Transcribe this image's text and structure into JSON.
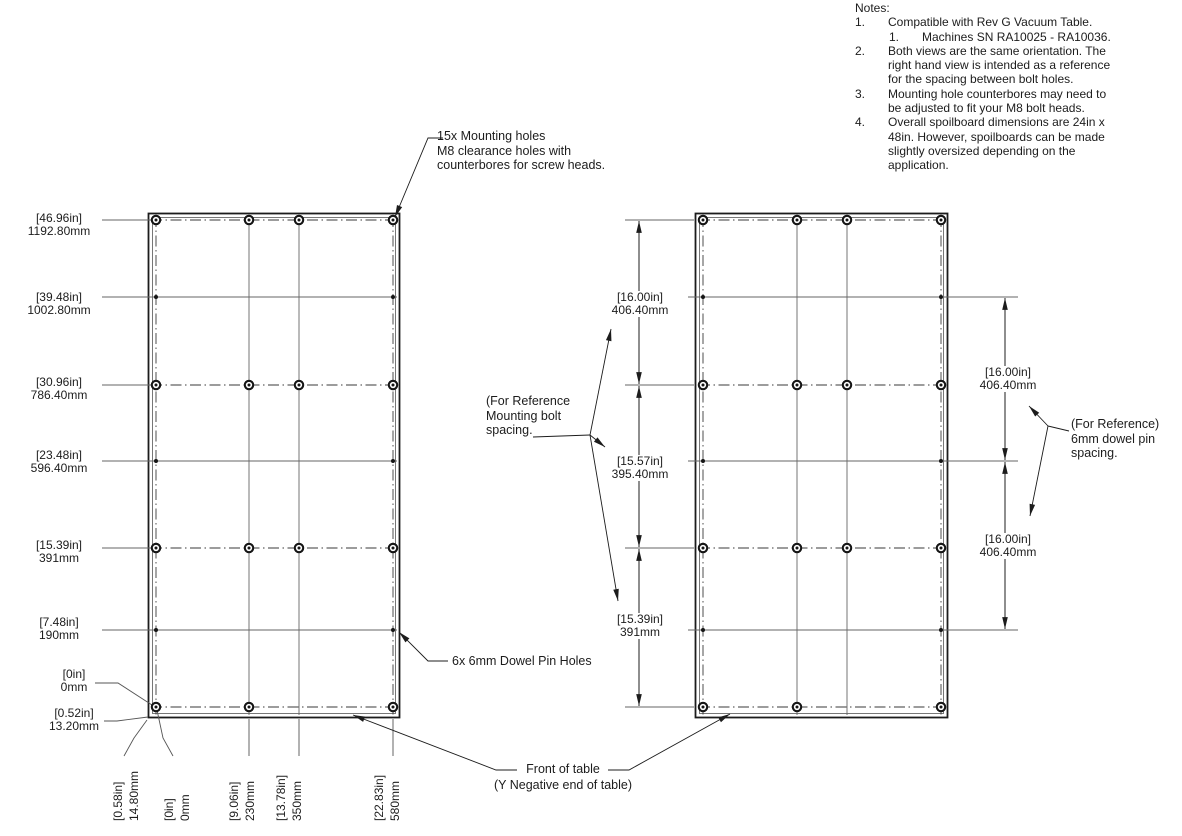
{
  "notes": {
    "title": "Notes:",
    "items": [
      {
        "num": "1.",
        "lines": [
          "Compatible with Rev G Vacuum Table."
        ]
      },
      {
        "num": "1.",
        "lines": [
          "Machines SN RA10025 - RA10036."
        ]
      },
      {
        "num": "2.",
        "lines": [
          "Both views are the same orientation. The",
          "right hand view is intended as a reference",
          "for the spacing between bolt holes."
        ]
      },
      {
        "num": "3.",
        "lines": [
          "Mounting hole counterbores may need to",
          "be adjusted to fit your M8 bolt heads."
        ]
      },
      {
        "num": "4.",
        "lines": [
          "Overall spoilboard dimensions are 24in x",
          "48in. However, spoilboards can be made",
          "slightly oversized depending on the",
          "application."
        ]
      }
    ]
  },
  "callouts": {
    "mounting": {
      "line1": "15x Mounting holes",
      "line2": "M8 clearance holes with",
      "line3": "counterbores for screw heads."
    },
    "dowel": {
      "text": "6x 6mm Dowel Pin Holes"
    },
    "ref_bolt": {
      "line1": "(For Reference",
      "line2": "Mounting bolt",
      "line3": "spacing."
    },
    "ref_dowel": {
      "line1": "(For Reference)",
      "line2": "6mm dowel pin",
      "line3": "spacing."
    },
    "front": {
      "line1": "Front of table",
      "line2": "(Y Negative end of table)"
    }
  },
  "left_dims": [
    {
      "in": "[46.96in]",
      "mm": "1192.80mm"
    },
    {
      "in": "[39.48in]",
      "mm": "1002.80mm"
    },
    {
      "in": "[30.96in]",
      "mm": "786.40mm"
    },
    {
      "in": "[23.48in]",
      "mm": "596.40mm"
    },
    {
      "in": "[15.39in]",
      "mm": "391mm"
    },
    {
      "in": "[7.48in]",
      "mm": "190mm"
    },
    {
      "in": "[0in]",
      "mm": "0mm"
    },
    {
      "in": "[0.52in]",
      "mm": "13.20mm"
    }
  ],
  "bottom_dims": [
    {
      "in": "[0.58in]",
      "mm": "14.80mm"
    },
    {
      "in": "[0in]",
      "mm": "0mm"
    },
    {
      "in": "[9.06in]",
      "mm": "230mm"
    },
    {
      "in": "[13.78in]",
      "mm": "350mm"
    },
    {
      "in": "[22.83in]",
      "mm": "580mm"
    }
  ],
  "mid_dims": [
    {
      "in": "[16.00in]",
      "mm": "406.40mm"
    },
    {
      "in": "[15.57in]",
      "mm": "395.40mm"
    },
    {
      "in": "[15.39in]",
      "mm": "391mm"
    }
  ],
  "right_dims": [
    {
      "in": "[16.00in]",
      "mm": "406.40mm"
    },
    {
      "in": "[16.00in]",
      "mm": "406.40mm"
    }
  ],
  "colors": {
    "line": "#1c1c1c",
    "grid": "#555555",
    "background": "#ffffff"
  }
}
